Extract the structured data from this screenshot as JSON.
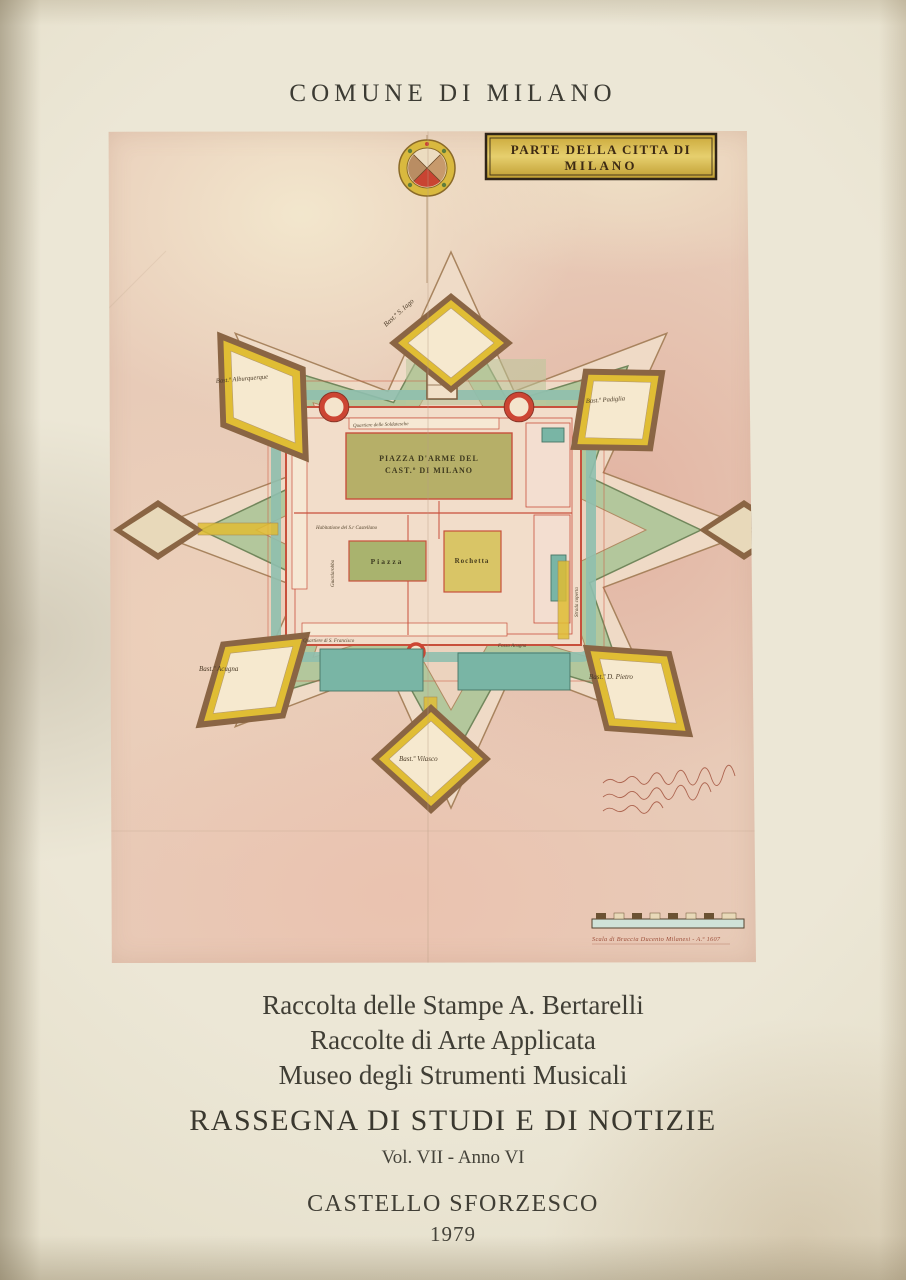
{
  "cover": {
    "publisher": "COMUNE DI MILANO",
    "institutions": [
      {
        "text": "Raccolta delle Stampe A. Bertarelli"
      },
      {
        "text": "Raccolte di Arte Applicata"
      },
      {
        "text": "Museo degli Strumenti Musicali"
      }
    ],
    "series_title": "RASSEGNA DI STUDI E DI NOTIZIE",
    "volume_info": "Vol. VII - Anno VI",
    "location": "CASTELLO SFORZESCO",
    "year": "1979",
    "ink_color": "#44423a",
    "background_color": "#e9e3d1"
  },
  "map": {
    "cartouche": {
      "line1": "PARTE DELLA CITTA DI",
      "line2": "MILANO",
      "gold": "#d4b144"
    },
    "piazza_armi": {
      "line1": "PIAZZA D'ARME DEL",
      "line2": "CAST.º DI MILANO"
    },
    "courtyards": {
      "piazza": "Piazza",
      "rochetta": "Rochetta"
    },
    "bastions": [
      {
        "label": "Bast.º S. Iago",
        "position": "north"
      },
      {
        "label": "Bast.º Alburquerque",
        "position": "northwest"
      },
      {
        "label": "Bast.º Padiglia",
        "position": "east"
      },
      {
        "label": "Bast.º Acugna",
        "position": "southwest"
      },
      {
        "label": "Bast.º D. Pietro",
        "position": "southeast"
      },
      {
        "label": "Bast.º Vilasco",
        "position": "south"
      }
    ],
    "small_labels": [
      {
        "text": "Quartiere delle Soldatesche"
      },
      {
        "text": "Habitatione del S.r Castellano"
      },
      {
        "text": "Quartiere di S. Francisco"
      },
      {
        "text": "Fosso Acugna"
      },
      {
        "text": "Guardarobba"
      },
      {
        "text": "Strada coperta"
      }
    ],
    "scale_caption": "Scala di Braccia Ducento Milanesi - A.º 1607",
    "palette": {
      "plate_pink": "#e8cbb8",
      "moat_green": "#b3c79c",
      "water_teal": "#7cb8a7",
      "wall_red": "#c8503c",
      "road_yellow": "#e0bd34",
      "bastion_dark": "#8a6544"
    }
  }
}
